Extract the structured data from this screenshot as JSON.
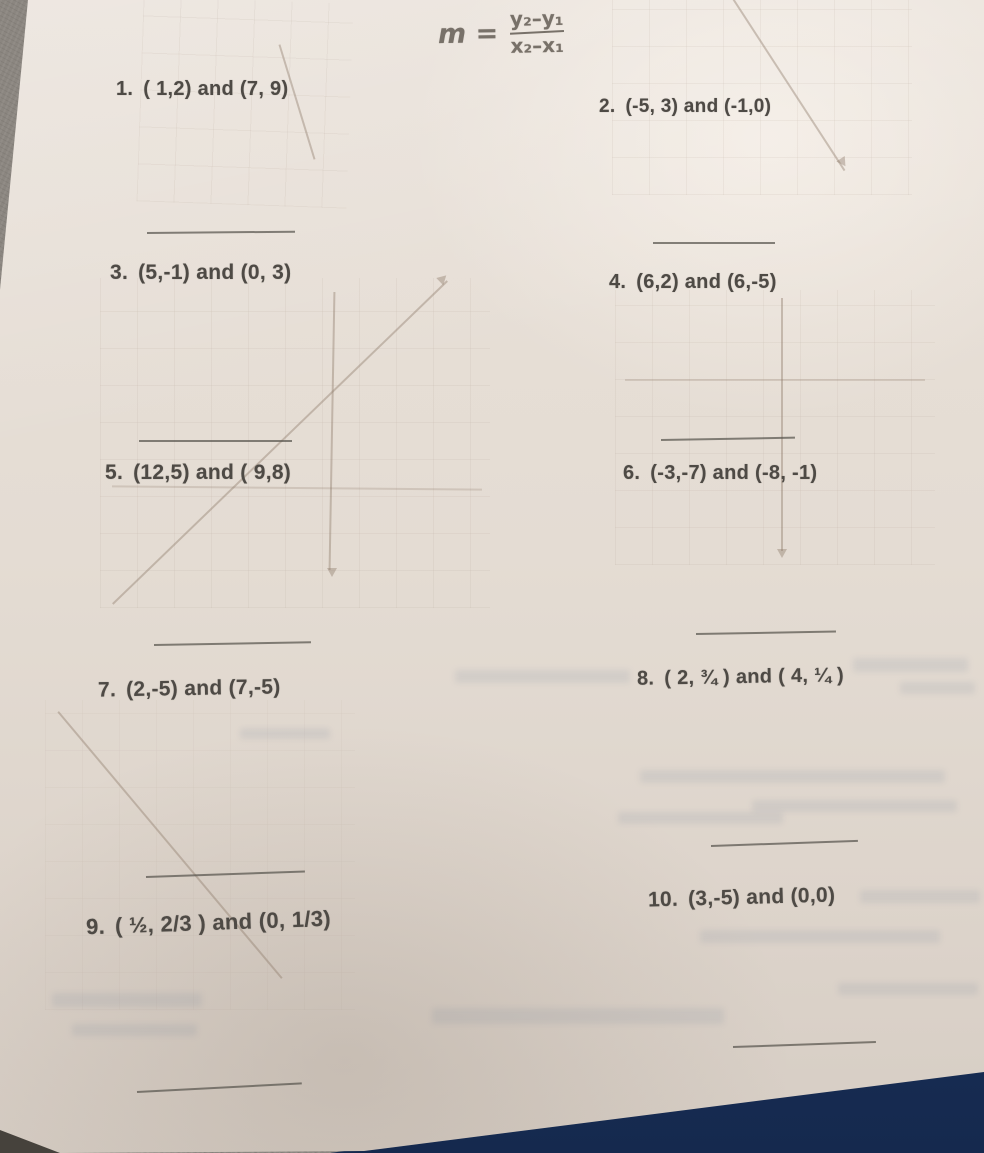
{
  "scene": {
    "surface_color": "#8b8680",
    "paper_color": "#e4dcd3",
    "binder_color": "#1c3a6b",
    "text_color": "#4e4a45"
  },
  "formula": {
    "lhs": "m =",
    "numerator": "y₂–y₁",
    "denominator": "x₂–x₁"
  },
  "problems": [
    {
      "label": "1.",
      "points": "( 1,2) and (7, 9)"
    },
    {
      "label": "2.",
      "points": "(-5, 3) and (-1,0)"
    },
    {
      "label": "3.",
      "points": "(5,-1) and (0, 3)"
    },
    {
      "label": "4.",
      "points": "(6,2) and (6,-5)"
    },
    {
      "label": "5.",
      "points": "(12,5) and ( 9,8)"
    },
    {
      "label": "6.",
      "points": "(-3,-7) and (-8, -1)"
    },
    {
      "label": "7.",
      "points": "(2,-5) and (7,-5)"
    },
    {
      "label": "8.",
      "points": "( 2, ¾ ) and ( 4, ¼ )"
    },
    {
      "label": "9.",
      "points": "( ½, 2/3 ) and (0, 1/3)"
    },
    {
      "label": "10.",
      "points": "(3,-5) and (0,0)"
    }
  ]
}
